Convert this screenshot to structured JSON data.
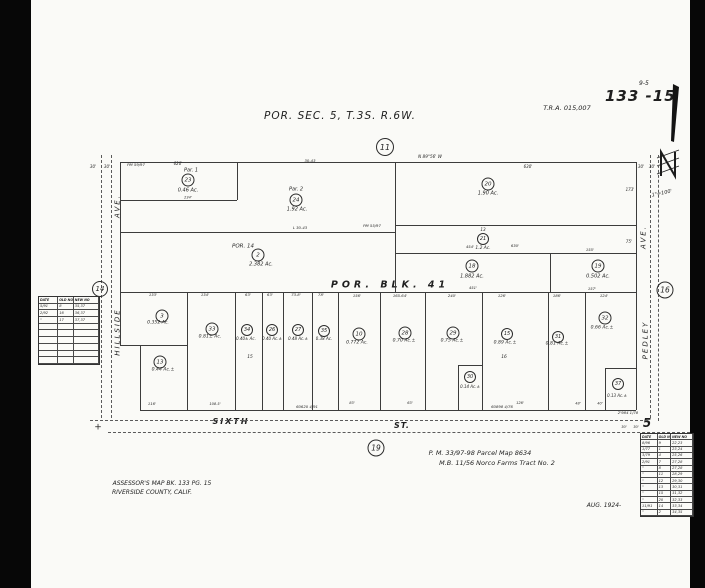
{
  "page": {
    "title": "POR.  SEC. 5, T.3S.  R.6W.",
    "tra": "T.R.A. 015,007",
    "sheet": "133 -15",
    "sheet_sup": "9-5",
    "scale": "1\"=100'",
    "north_label": "N",
    "reference_1": "P. M. 33/97-98 Parcel Map  8634",
    "reference_2": "M.B. 11/56  Norco  Farms  Tract  No. 2",
    "assessor_1": "ASSESSOR'S    MAP    BK. 133    PG. 15",
    "assessor_2": "RIVERSIDE     COUNTY,    CALIF.",
    "date_note": "AUG. 1924-"
  },
  "streets": {
    "left_1": "HILLSIDE",
    "left_2": "AVE.",
    "right_1": "PEDLEY",
    "right_2": "AVE.",
    "bottom_1": "SIXTH",
    "bottom_2": "ST.",
    "bottom_number": "5",
    "block_label": "POR.    BLK.    41"
  },
  "circles": [
    {
      "n": "11",
      "x": 385,
      "y": 147,
      "d": 16
    },
    {
      "n": "14",
      "x": 100,
      "y": 289,
      "d": 14
    },
    {
      "n": "16",
      "x": 665,
      "y": 290,
      "d": 15
    },
    {
      "n": "19",
      "x": 376,
      "y": 448,
      "d": 15
    },
    {
      "n": "23",
      "x": 188,
      "y": 180,
      "d": 11
    },
    {
      "n": "24",
      "x": 296,
      "y": 200,
      "d": 11
    },
    {
      "n": "20",
      "x": 488,
      "y": 184,
      "d": 11
    },
    {
      "n": "21",
      "x": 483,
      "y": 239,
      "d": 10
    },
    {
      "n": "2",
      "x": 258,
      "y": 255,
      "d": 11
    },
    {
      "n": "18",
      "x": 472,
      "y": 266,
      "d": 11
    },
    {
      "n": "19",
      "x": 598,
      "y": 266,
      "d": 11
    },
    {
      "n": "3",
      "x": 162,
      "y": 316,
      "d": 11
    },
    {
      "n": "13",
      "x": 160,
      "y": 362,
      "d": 11
    },
    {
      "n": "33",
      "x": 212,
      "y": 329,
      "d": 11
    },
    {
      "n": "34",
      "x": 247,
      "y": 330,
      "d": 10
    },
    {
      "n": "26",
      "x": 272,
      "y": 330,
      "d": 10
    },
    {
      "n": "27",
      "x": 298,
      "y": 330,
      "d": 10
    },
    {
      "n": "35",
      "x": 324,
      "y": 331,
      "d": 10
    },
    {
      "n": "10",
      "x": 359,
      "y": 334,
      "d": 11
    },
    {
      "n": "28",
      "x": 405,
      "y": 333,
      "d": 11
    },
    {
      "n": "29",
      "x": 453,
      "y": 333,
      "d": 11
    },
    {
      "n": "30",
      "x": 470,
      "y": 377,
      "d": 10
    },
    {
      "n": "15",
      "x": 507,
      "y": 334,
      "d": 10
    },
    {
      "n": "31",
      "x": 558,
      "y": 337,
      "d": 10
    },
    {
      "n": "32",
      "x": 605,
      "y": 318,
      "d": 11
    },
    {
      "n": "37",
      "x": 618,
      "y": 384,
      "d": 10
    }
  ],
  "labels": [
    {
      "t": "30'",
      "x": 93,
      "y": 167,
      "s": 4
    },
    {
      "t": "30'",
      "x": 107,
      "y": 167,
      "s": 4
    },
    {
      "t": "PM 59/97",
      "x": 136,
      "y": 165,
      "s": 3.8
    },
    {
      "t": "620'",
      "x": 178,
      "y": 164,
      "s": 4
    },
    {
      "t": "Par.  1",
      "x": 191,
      "y": 171,
      "s": 5
    },
    {
      "t": "0.46 Ac.",
      "x": 188,
      "y": 191,
      "s": 5
    },
    {
      "t": "234'",
      "x": 188,
      "y": 198,
      "s": 3.5
    },
    {
      "t": "30-43",
      "x": 310,
      "y": 161,
      "s": 3.8
    },
    {
      "t": "N 89°56' W",
      "x": 430,
      "y": 157,
      "s": 4.2
    },
    {
      "t": "630'",
      "x": 528,
      "y": 167,
      "s": 4
    },
    {
      "t": "30'",
      "x": 641,
      "y": 167,
      "s": 4
    },
    {
      "t": "30'",
      "x": 652,
      "y": 167,
      "s": 4
    },
    {
      "t": "173'",
      "x": 630,
      "y": 190,
      "s": 4
    },
    {
      "t": "Par.  2",
      "x": 296,
      "y": 190,
      "s": 5
    },
    {
      "t": "1.92 Ac.",
      "x": 297,
      "y": 210,
      "s": 5
    },
    {
      "t": "1.90 Ac.",
      "x": 488,
      "y": 194,
      "s": 5
    },
    {
      "t": "L 30-43",
      "x": 300,
      "y": 228,
      "s": 3.8
    },
    {
      "t": "PM 55/97",
      "x": 372,
      "y": 226,
      "s": 3.8
    },
    {
      "t": "13",
      "x": 483,
      "y": 230,
      "s": 4.2
    },
    {
      "t": "1.2 Ac.",
      "x": 483,
      "y": 249,
      "s": 4.4
    },
    {
      "t": "630'",
      "x": 515,
      "y": 246,
      "s": 3.8
    },
    {
      "t": "75'",
      "x": 629,
      "y": 242,
      "s": 4
    },
    {
      "t": "POR. 14",
      "x": 243,
      "y": 247,
      "s": 5.5
    },
    {
      "t": "2.382 Ac.",
      "x": 261,
      "y": 265,
      "s": 5
    },
    {
      "t": "454'",
      "x": 470,
      "y": 247,
      "s": 3.8
    },
    {
      "t": "155'",
      "x": 590,
      "y": 250,
      "s": 3.8
    },
    {
      "t": "1.882 Ac.",
      "x": 472,
      "y": 277,
      "s": 5
    },
    {
      "t": "0.502 Ac.",
      "x": 598,
      "y": 277,
      "s": 5
    },
    {
      "t": "451'",
      "x": 473,
      "y": 288,
      "s": 3.8
    },
    {
      "t": "157'",
      "x": 592,
      "y": 289,
      "s": 3.8
    },
    {
      "t": "133'",
      "x": 153,
      "y": 295,
      "s": 3.8
    },
    {
      "t": "134'",
      "x": 205,
      "y": 295,
      "s": 3.8
    },
    {
      "t": "63'",
      "x": 248,
      "y": 295,
      "s": 3.8
    },
    {
      "t": "63'",
      "x": 270,
      "y": 295,
      "s": 3.8
    },
    {
      "t": "73.8'",
      "x": 296,
      "y": 295,
      "s": 3.8
    },
    {
      "t": "78'",
      "x": 321,
      "y": 295,
      "s": 3.8
    },
    {
      "t": "156'",
      "x": 357,
      "y": 296,
      "s": 3.8
    },
    {
      "t": "165.64'",
      "x": 400,
      "y": 296,
      "s": 3.8
    },
    {
      "t": "240'",
      "x": 452,
      "y": 296,
      "s": 3.8
    },
    {
      "t": "126'",
      "x": 502,
      "y": 296,
      "s": 3.8
    },
    {
      "t": "186'",
      "x": 557,
      "y": 296,
      "s": 3.8
    },
    {
      "t": "124'",
      "x": 604,
      "y": 296,
      "s": 3.8
    },
    {
      "t": "0.352 Ac.",
      "x": 158,
      "y": 324,
      "s": 4.6
    },
    {
      "t": "0.44 Ac.±",
      "x": 163,
      "y": 371,
      "s": 4.6
    },
    {
      "t": "0.81± Ac.",
      "x": 210,
      "y": 338,
      "s": 4.6
    },
    {
      "t": "0.40± Ac.",
      "x": 246,
      "y": 339,
      "s": 4
    },
    {
      "t": "0.40 Ac.±",
      "x": 272,
      "y": 339,
      "s": 4
    },
    {
      "t": "0.48 Ac.±",
      "x": 298,
      "y": 339,
      "s": 4
    },
    {
      "t": "0.38 Ac.",
      "x": 324,
      "y": 339,
      "s": 4
    },
    {
      "t": "15",
      "x": 250,
      "y": 358,
      "s": 4.4
    },
    {
      "t": "0.772 Ac.",
      "x": 357,
      "y": 344,
      "s": 4.6
    },
    {
      "t": "0.70 Ac.±",
      "x": 404,
      "y": 342,
      "s": 4.6
    },
    {
      "t": "0.75 Ac.±",
      "x": 452,
      "y": 342,
      "s": 4.6
    },
    {
      "t": "0.14 Ac.±",
      "x": 470,
      "y": 387,
      "s": 4
    },
    {
      "t": "0.89 Ac.±",
      "x": 505,
      "y": 344,
      "s": 4.6
    },
    {
      "t": "16",
      "x": 504,
      "y": 358,
      "s": 4.4
    },
    {
      "t": "0.81 Ac.±",
      "x": 557,
      "y": 345,
      "s": 4.6
    },
    {
      "t": "0.66 Ac.±",
      "x": 602,
      "y": 329,
      "s": 4.6
    },
    {
      "t": "0.13 Ac.±",
      "x": 617,
      "y": 396,
      "s": 4
    },
    {
      "t": "116'",
      "x": 152,
      "y": 404,
      "s": 3.8
    },
    {
      "t": "108.5'",
      "x": 215,
      "y": 405,
      "s": 3.6
    },
    {
      "t": "83'",
      "x": 352,
      "y": 404,
      "s": 3.6
    },
    {
      "t": "63'",
      "x": 410,
      "y": 404,
      "s": 3.6
    },
    {
      "t": "126'",
      "x": 520,
      "y": 404,
      "s": 3.6
    },
    {
      "t": "48'",
      "x": 578,
      "y": 404,
      "s": 3.5
    },
    {
      "t": "40'",
      "x": 600,
      "y": 404,
      "s": 3.5
    },
    {
      "t": "60620 4/91",
      "x": 307,
      "y": 407,
      "s": 3.8
    },
    {
      "t": "60898 4/76",
      "x": 502,
      "y": 407,
      "s": 3.8
    },
    {
      "t": "2'984 1/78",
      "x": 628,
      "y": 413,
      "s": 3.8
    },
    {
      "t": "+",
      "x": 98,
      "y": 428,
      "s": 9
    },
    {
      "t": "30'",
      "x": 624,
      "y": 428,
      "s": 3.6
    },
    {
      "t": "30'",
      "x": 636,
      "y": 428,
      "s": 3.6
    }
  ],
  "lines": [
    [
      120,
      162,
      516,
      0
    ],
    [
      140,
      410,
      496,
      0
    ],
    [
      120,
      162,
      0,
      184
    ],
    [
      636,
      162,
      0,
      248
    ],
    [
      120,
      200,
      117,
      0
    ],
    [
      237,
      162,
      0,
      38
    ],
    [
      120,
      232,
      275,
      0
    ],
    [
      395,
      162,
      0,
      130
    ],
    [
      395,
      225,
      241,
      0
    ],
    [
      395,
      253,
      241,
      0
    ],
    [
      120,
      292,
      516,
      0
    ],
    [
      550,
      253,
      0,
      39
    ],
    [
      187,
      292,
      0,
      118
    ],
    [
      235,
      292,
      0,
      118
    ],
    [
      262,
      292,
      0,
      118
    ],
    [
      283,
      292,
      0,
      118
    ],
    [
      312,
      292,
      0,
      118
    ],
    [
      338,
      292,
      0,
      118
    ],
    [
      380,
      292,
      0,
      118
    ],
    [
      425,
      292,
      0,
      118
    ],
    [
      482,
      292,
      0,
      118
    ],
    [
      548,
      292,
      0,
      118
    ],
    [
      585,
      292,
      0,
      118
    ],
    [
      120,
      345,
      67,
      0
    ],
    [
      140,
      345,
      0,
      65
    ],
    [
      458,
      365,
      24,
      0
    ],
    [
      458,
      365,
      0,
      45
    ],
    [
      605,
      368,
      31,
      0
    ],
    [
      605,
      368,
      0,
      42
    ]
  ],
  "dashes": [
    {
      "v": 1,
      "x": 101,
      "y": 155,
      "len": 263
    },
    {
      "v": 1,
      "x": 111,
      "y": 155,
      "len": 263
    },
    {
      "v": 1,
      "x": 650,
      "y": 155,
      "len": 263
    },
    {
      "v": 1,
      "x": 658,
      "y": 155,
      "len": 266
    },
    {
      "v": 0,
      "x": 90,
      "y": 420,
      "len": 558
    },
    {
      "v": 0,
      "x": 108,
      "y": 432,
      "len": 582
    }
  ],
  "tables": {
    "left": {
      "x": 38,
      "y": 296,
      "w": 60,
      "h": 67,
      "rows": [
        [
          "DATE",
          "OLD NO",
          "NEW NO"
        ],
        [
          "5/91",
          "8",
          "35,37"
        ],
        [
          "2/92",
          "16",
          "36,37"
        ],
        [
          "\"",
          "17",
          "37,37"
        ],
        [
          "",
          "",
          ""
        ],
        [
          "",
          "",
          ""
        ],
        [
          "",
          "",
          ""
        ],
        [
          "",
          "",
          ""
        ],
        [
          "",
          "",
          ""
        ],
        [
          "",
          "",
          ""
        ]
      ]
    },
    "right": {
      "x": 640,
      "y": 433,
      "w": 52,
      "h": 82,
      "rows": [
        [
          "DATE",
          "OLD NO",
          "NEW NO"
        ],
        [
          "8/96",
          "9",
          "22,23"
        ],
        [
          "1/77",
          "1",
          "23,24"
        ],
        [
          "3/79",
          "4",
          "25,26"
        ],
        [
          "2/91",
          "7",
          "27,28"
        ],
        [
          "\"",
          "8",
          "27,28"
        ],
        [
          "\"",
          "11",
          "28,29"
        ],
        [
          "\"",
          "12",
          "29,30"
        ],
        [
          "\"",
          "13",
          "30,31"
        ],
        [
          "\"",
          "15",
          "31,32"
        ],
        [
          "\"",
          "20",
          "32,33"
        ],
        [
          "11/91",
          "14",
          "33,34"
        ],
        [
          "\"",
          "2",
          "34,35"
        ]
      ]
    }
  }
}
